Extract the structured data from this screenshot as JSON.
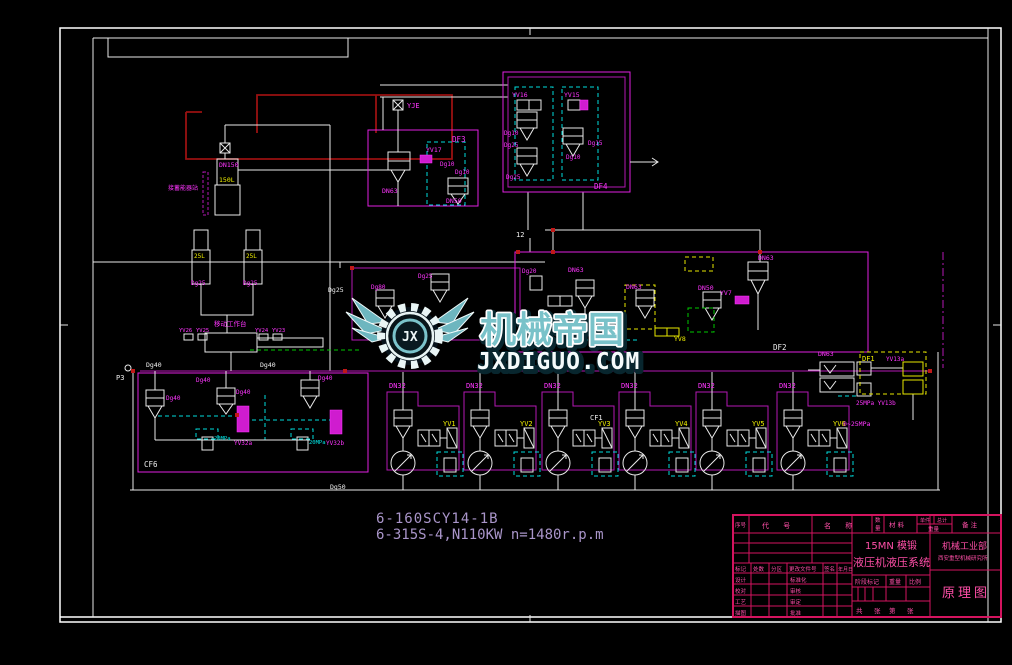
{
  "watermark": {
    "brand": "机械帝国",
    "domain": "JXDIGUO.COM",
    "monogram": "JX"
  },
  "notes": {
    "line1": "6-160SCY14-1B",
    "line2": "6-315S-4,N110KW  n=1480r.p.m"
  },
  "zone_labels": {
    "df1": "DF1",
    "df2": "DF2",
    "df3": "DF3",
    "df4": "DF4",
    "cf1": "CF1",
    "cf6": "CF6"
  },
  "pump_units": [
    {
      "dn": "DN32",
      "yv": "YV1"
    },
    {
      "dn": "DN32",
      "yv": "YV2"
    },
    {
      "dn": "DN32",
      "yv": "YV3"
    },
    {
      "dn": "DN32",
      "yv": "YV4"
    },
    {
      "dn": "DN32",
      "yv": "YV5"
    },
    {
      "dn": "DN32",
      "yv": "YV6"
    }
  ],
  "labels": {
    "yje": "YJE",
    "df3_yv17": "YV17",
    "df3_dg10a": "Dg10",
    "df3_dg10b": "Dg10",
    "df3_dn63": "DN63",
    "df3_dn50": "DN50",
    "df4_yv16": "YV16",
    "df4_yv15": "YV15",
    "df4_dg10a": "Dg10",
    "df4_dg25a": "Dg25",
    "df4_dg15": "Dg15",
    "df4_dg10b": "Dg10",
    "df4_dg25b": "Dg25",
    "node12": "12",
    "df2_dg20": "Dg20",
    "df2_dn63a": "DN63",
    "df2_dn63b": "DN63",
    "df2_dn50": "DN50",
    "df2_dn63c": "DN63",
    "df2_yv7": "YV7",
    "df2_yv8": "YV8",
    "cv_dg80": "Dg80",
    "cv_dg25": "Dg25",
    "dg25_line": "Dg25",
    "acc_label": "DN150",
    "acc_vol": "150L",
    "acc_note": "接蓄能器站",
    "cyl_a": "25L",
    "cyl_b": "25L",
    "cyl_a2": "Dg25",
    "cyl_b2": "Dg25",
    "table_note": "移动工作台",
    "yv26": "YV26",
    "yv25": "YV25",
    "yv24": "YV24",
    "yv23": "YV23",
    "dg40_line_a": "Dg40",
    "dg40_line_b": "Dg40",
    "p3": "P3",
    "cf6_dg40_a": "Dg40",
    "cf6_dg40_b": "Dg40",
    "cf6_dg40_c": "Dg40",
    "cf6_dg40_d": "Dg40",
    "cf6_yv32a": "YV32a",
    "cf6_yv32b": "YV32b",
    "cf6_p20a": "20MPa",
    "cf6_p20b": "20MPa",
    "right_dn63": "DN63",
    "df1_tag": "DF1",
    "yv13a": "YV13a",
    "yv13b": "25MPa YV13b",
    "p025": "0~25MPa",
    "dg50": "Dg50"
  },
  "titleblock": {
    "bom": {
      "no": "序号",
      "code": "代  号",
      "name": "名  称",
      "qty1": "数",
      "qty2": "量",
      "mat": "材 料",
      "unit": "单件",
      "total": "总计",
      "weight": "重量",
      "note": "备 注"
    },
    "rev": {
      "mark": "标记",
      "count": "处数",
      "zone": "分区",
      "doc": "更改文件号",
      "sign": "签名",
      "date": "年月日"
    },
    "roles": {
      "r1": "设计",
      "r2": "校对",
      "r3": "工艺",
      "r4": "描图",
      "m1": "标准化",
      "m2": "审核",
      "m3": "审定",
      "m4": "批准"
    },
    "stage": {
      "header": "阶段标记",
      "weight": "重量",
      "scale": "比例"
    },
    "sheet": {
      "gong": "共",
      "zhang1": "张",
      "di": "第",
      "zhang2": "张"
    },
    "product": {
      "line1": "15MN 模锻",
      "line2": "液压机液压系统"
    },
    "org": {
      "line1": "机械工业部",
      "line2": "西安重型机械研究所"
    },
    "title": "原理图"
  }
}
